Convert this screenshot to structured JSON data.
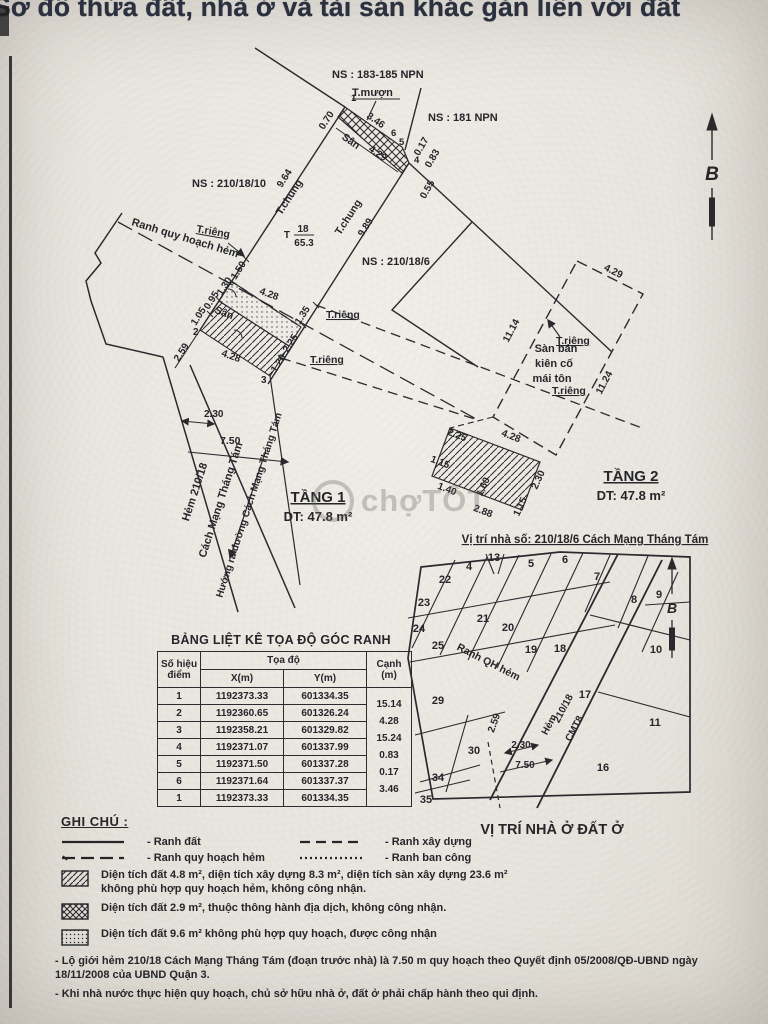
{
  "page": {
    "title": "Sơ đồ thửa đất, nhà ở và tài sản khác gắn liền với đất",
    "watermark": "chợTỐT"
  },
  "drawing": {
    "north_label": "B",
    "ns_183_185": "NS : 183-185 NPN",
    "ns_181": "NS : 181 NPN",
    "ns_210_18_10": "NS : 210/18/10",
    "ns_210_18_6": "NS : 210/18/6",
    "t_muon": "T.mượn",
    "t_chung": "T.chung",
    "t_rieng": "T.riêng",
    "ranh_qh_hem": "Ranh quy hoạch hẻm",
    "parcel_t": "T",
    "parcel_no": "18",
    "parcel_area": "65.3",
    "san": "Sân",
    "san_ban_1": "Sàn bán",
    "san_ban_2": "kiên cố",
    "san_ban_3": "mái tôn",
    "tang1": "TẦNG 1",
    "tang1_dt": "DT: 47.8 m²",
    "tang2": "TẦNG 2",
    "tang2_dt": "DT: 47.8 m²",
    "hem_210_18": "Hẻm 210/18",
    "cmt8": "Cách Mạng Tháng Tám",
    "huong_ra": "Hướng ra đường Cách Mạng Tháng Tám",
    "vi_tri_caption": "Vị trí nhà số: 210/18/6 Cách Mạng Tháng Tám",
    "dims": {
      "d070": "0.70",
      "d346": "3.46",
      "d429": "4.29",
      "d017": "0.17",
      "d083": "0.83",
      "d055": "0.55",
      "d964": "9.64",
      "d989": "9.89",
      "d150": "1.50",
      "d130": "1.30",
      "d095": "0.95",
      "d105": "1.05",
      "d259": "2.59",
      "d428a": "4.28",
      "d428b": "4.28",
      "d135": "1.35",
      "d225a": "2.25",
      "d120": "1.20",
      "d230a": "2.30",
      "d750a": "7.50",
      "d1114": "11.14",
      "d1124": "11.24",
      "d429b": "4.29",
      "d225b": "2.25",
      "d428c": "4.28",
      "d115a": "1.15",
      "d230b": "2.30",
      "d140": "1.40",
      "d160": "1.60",
      "d288": "2.88",
      "d115b": "1.15",
      "p1": "1",
      "p2": "2",
      "p3": "3",
      "p4": "4",
      "p5": "5",
      "p6": "6"
    }
  },
  "table": {
    "title": "BẢNG LIỆT KÊ TỌA ĐỘ GÓC RANH",
    "col_point_1": "Số hiệu",
    "col_point_2": "điểm",
    "col_coord": "Tọa độ",
    "col_x": "X(m)",
    "col_y": "Y(m)",
    "col_edge_1": "Cạnh",
    "col_edge_2": "(m)",
    "rows": [
      {
        "p": "1",
        "x": "1192373.33",
        "y": "601334.35"
      },
      {
        "p": "2",
        "x": "1192360.65",
        "y": "601326.24"
      },
      {
        "p": "3",
        "x": "1192358.21",
        "y": "601329.82"
      },
      {
        "p": "4",
        "x": "1192371.07",
        "y": "601337.99"
      },
      {
        "p": "5",
        "x": "1192371.50",
        "y": "601337.28"
      },
      {
        "p": "6",
        "x": "1192371.64",
        "y": "601337.37"
      },
      {
        "p": "1",
        "x": "1192373.33",
        "y": "601334.35"
      }
    ],
    "edges": [
      "15.14",
      "4.28",
      "15.24",
      "0.83",
      "0.17",
      "3.46"
    ]
  },
  "map": {
    "caption": "VỊ TRÍ NHÀ Ở ĐẤT Ở",
    "north_label": "B",
    "ranh_qh_hem": "Ranh QH hẻm",
    "hem_1": "Hẻm",
    "hem_2": "210/18",
    "hem_3": "CMT8",
    "d259": "2.59",
    "d230": "2.30",
    "d750": "7.50",
    "plots": [
      "4",
      "5",
      "6",
      "7",
      "8",
      "9",
      "10",
      "11",
      "13",
      "16",
      "17",
      "18",
      "19",
      "20",
      "21",
      "22",
      "23",
      "24",
      "25",
      "29",
      "30",
      "34",
      "35"
    ]
  },
  "legend": {
    "title": "GHI CHÚ :",
    "line_items": [
      {
        "label": "- Ranh đất"
      },
      {
        "label": "- Ranh xây dựng"
      },
      {
        "label": "- Ranh quy hoạch hẻm"
      },
      {
        "label": "- Ranh ban công"
      }
    ],
    "swatch_items": [
      {
        "text": "Diện tích đất 4.8 m², diện tích xây dựng 8.3 m², diện tích sàn xây dựng 23.6 m² không phù hợp quy hoạch hẻm, không công nhận."
      },
      {
        "text": "Diện tích đất 2.9 m², thuộc thông hành địa dịch, không công nhận."
      },
      {
        "text": "Diện tích đất 9.6 m² không phù hợp quy hoạch, được công nhận"
      }
    ],
    "notes": [
      "- Lộ giới hẻm 210/18 Cách Mạng Tháng Tám (đoạn trước nhà) là 7.50 m quy hoạch theo Quyết định 05/2008/QĐ-UBND ngày 18/11/2008 của UBND Quận 3.",
      "- Khi nhà nước thực hiện quy hoạch, chủ sở hữu nhà ở, đất ở phải chấp hành theo qui định."
    ]
  }
}
